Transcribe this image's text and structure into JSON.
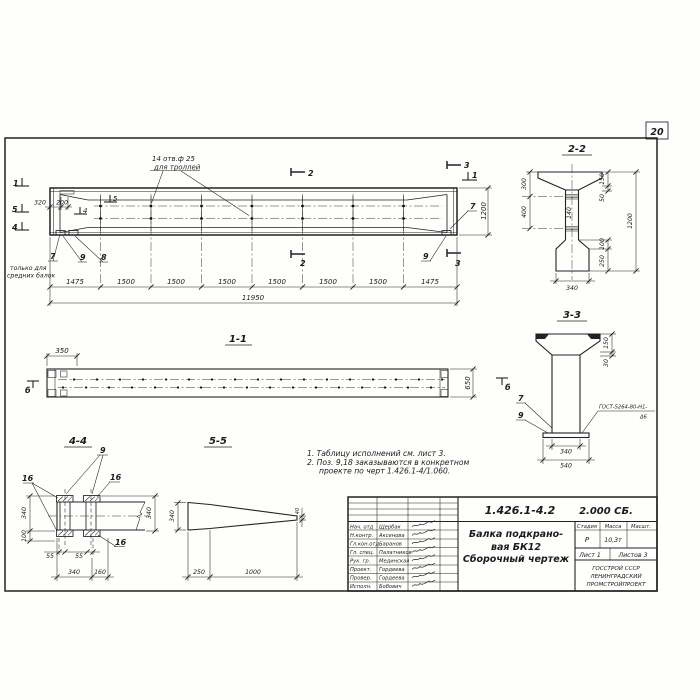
{
  "sheet": {
    "page_number": "20"
  },
  "main_view": {
    "callout_line1": "14 отв.ф 25",
    "callout_line2": "для троллей",
    "note_left_line1": "только для",
    "note_left_line2": "средних балок",
    "pos_7_left": "7",
    "pos_8": "8",
    "pos_9_left": "9",
    "pos_7_right": "7",
    "pos_9_right": "9",
    "mark_1_left": "1",
    "mark_5_left": "5",
    "mark_4_left": "4",
    "mark_5_inner": "5",
    "mark_4_inner": "4",
    "mark_2_top": "2",
    "mark_2_bottom": "2",
    "mark_3_top": "3",
    "mark_3_bottom": "3",
    "mark_1_right": "1",
    "dim_320": "320",
    "dim_200": "200",
    "dim_1200": "1200",
    "dims": [
      "1475",
      "1500",
      "1500",
      "1500",
      "1500",
      "1500",
      "1500",
      "1475"
    ],
    "dim_total": "11950"
  },
  "view_1_1": {
    "title": "1-1",
    "dim_350": "350",
    "dim_650": "650",
    "mark_b_left": "б",
    "mark_b_right": "б"
  },
  "view_2_2": {
    "title": "2-2",
    "dim_300": "300",
    "dim_400": "400",
    "dim_140": "140",
    "dim_150": "150",
    "dim_50": "50",
    "dim_1200": "1200",
    "dim_100": "100",
    "dim_250": "250",
    "dim_340": "340"
  },
  "view_3_3": {
    "title": "3-3",
    "dim_150": "150",
    "dim_30": "30",
    "dim_340": "340",
    "dim_540": "540",
    "pos_7": "7",
    "pos_9": "9",
    "weld_line1": "ГОСТ-5264-80-Н1-",
    "weld_line2": "Δ6"
  },
  "view_4_4": {
    "title": "4-4",
    "pos_9": "9",
    "pos_16_a": "16",
    "pos_16_b": "16",
    "pos_16_c": "16",
    "dim_340_left": "340",
    "dim_100": "100",
    "dim_55_a": "55",
    "dim_55_b": "55",
    "dim_340_bottom": "340",
    "dim_160": "160",
    "dim_340_right": "340"
  },
  "view_5_5": {
    "title": "5-5",
    "dim_340": "340",
    "dim_250": "250",
    "dim_1000": "1000",
    "dim_40": "40"
  },
  "notes": [
    "1. Таблицу исполнений см. лист 3.",
    "2. Поз. 9,18 заказываются в конкретном",
    "проекте по черт 1.426.1-4/1.060."
  ],
  "title_block": {
    "doc_number": "1.426.1-4.2",
    "doc_code": "2.000 СБ.",
    "title_lines": [
      "Балка подкрано-",
      "вая БК12",
      "Сборочный чертеж"
    ],
    "stage_header": "Стадия",
    "mass_header": "Масса",
    "scale_header": "Масшт.",
    "stage": "Р",
    "mass": "10,3т",
    "sheet": "Лист 1",
    "sheets": "Листов 3",
    "org": [
      "ГОССТРОЙ СССР",
      "ЛЕНИНГРАДСКИЙ",
      "ПРОМСТРОЙПРОЕКТ"
    ],
    "signers": [
      {
        "role": "Нач. отд",
        "name": "Щербак"
      },
      {
        "role": "Н.контр.",
        "name": "Аксенова"
      },
      {
        "role": "Гл.кон.отд",
        "name": "Баранов"
      },
      {
        "role": "Гл. спец.",
        "name": "Палатников"
      },
      {
        "role": "Рук. гр.",
        "name": "Мединская"
      },
      {
        "role": "Проект.",
        "name": "Гордеева"
      },
      {
        "role": "Провер.",
        "name": "Гордеева"
      },
      {
        "role": "Исполн.",
        "name": "Бобович"
      }
    ]
  }
}
